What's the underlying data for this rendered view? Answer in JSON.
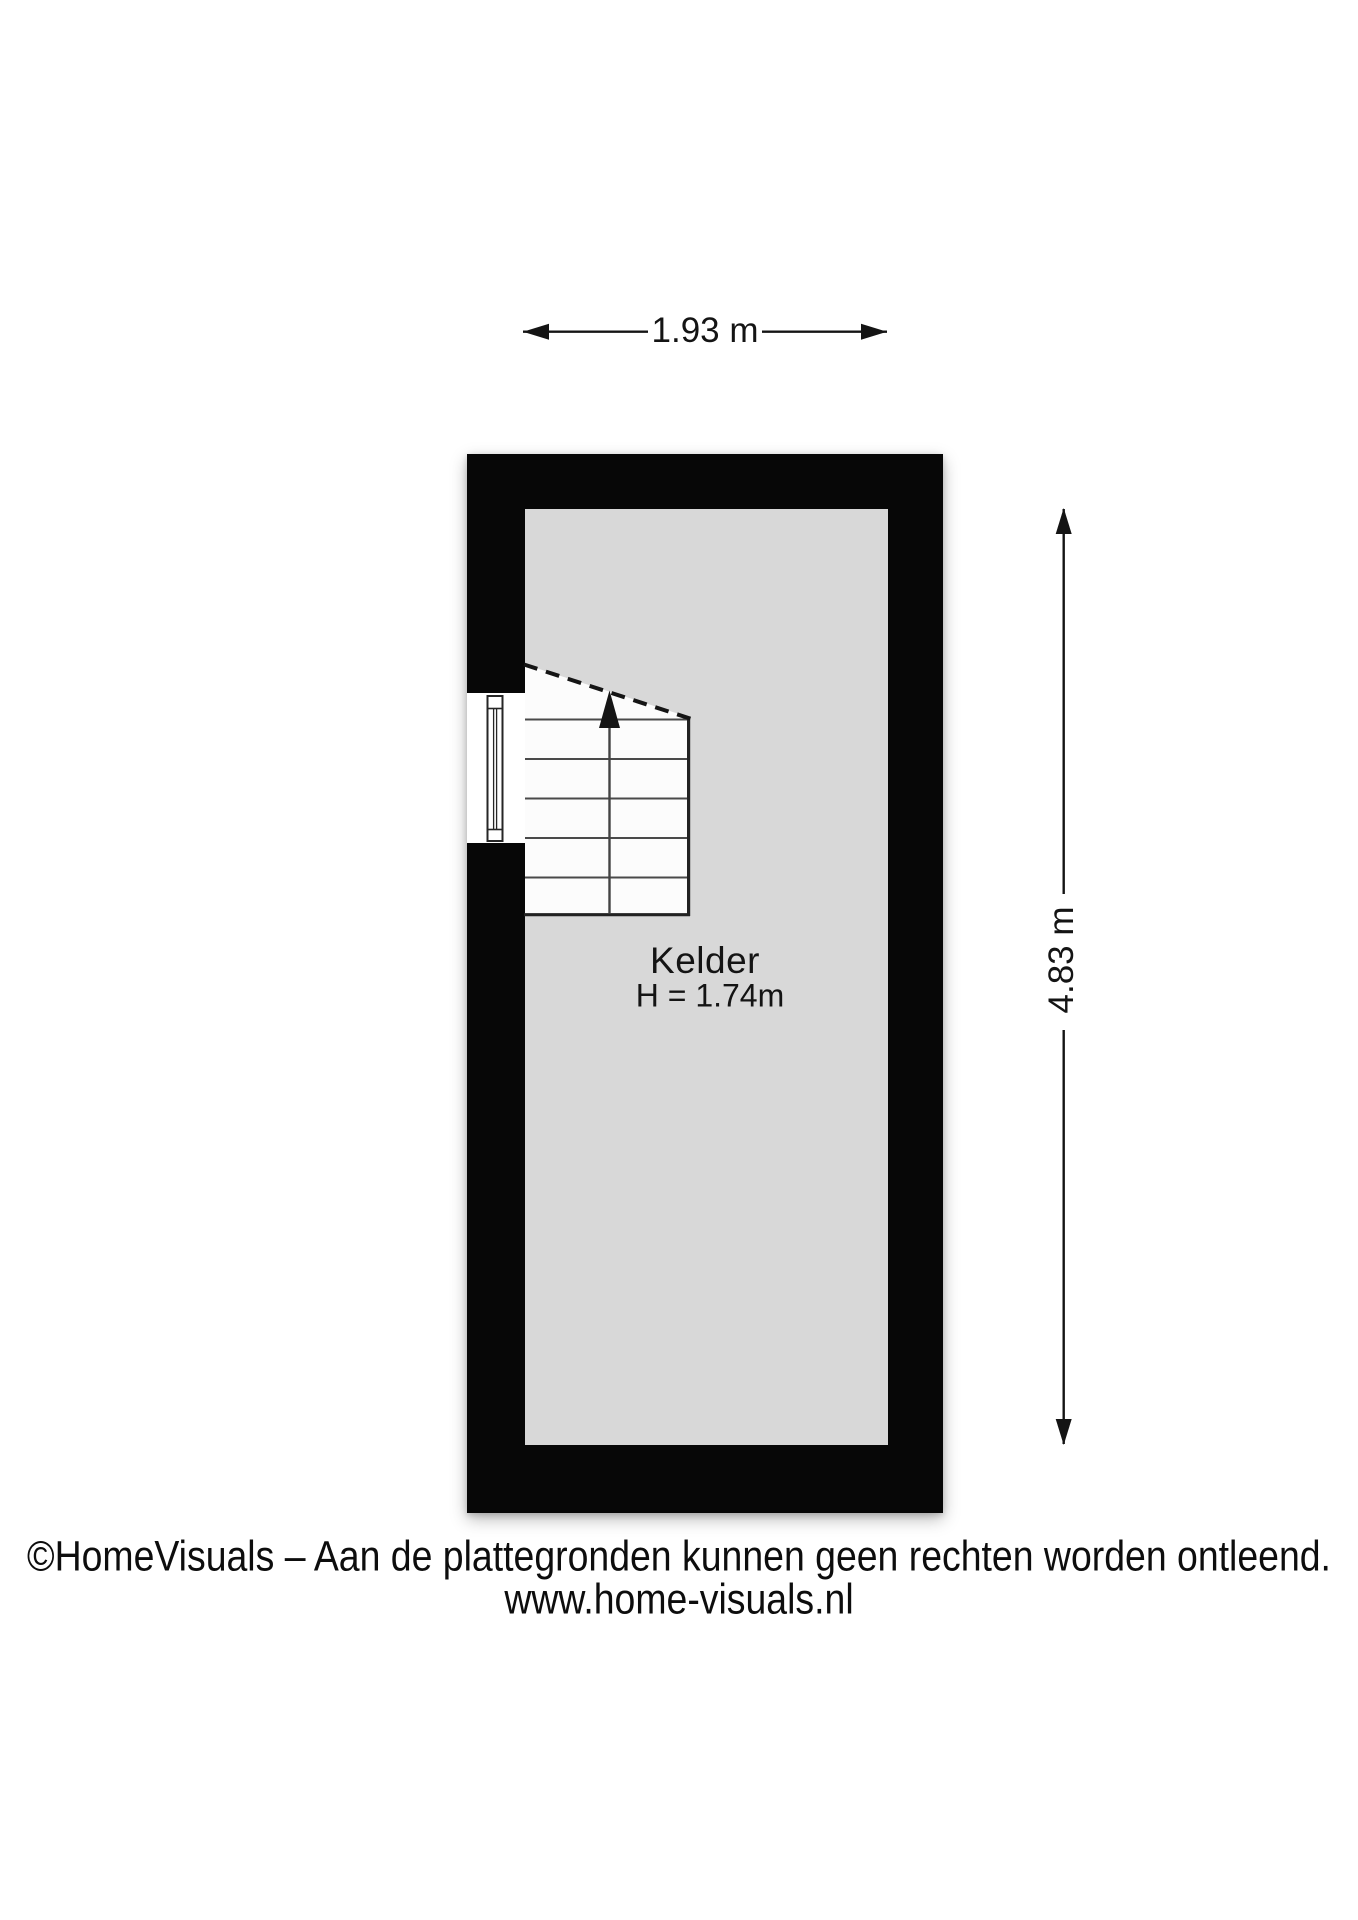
{
  "meta": {
    "type": "floorplan",
    "floor_name": "Kelder"
  },
  "plan": {
    "room": {
      "label": "Kelder",
      "ceiling_height": "H = 1.74m"
    },
    "dimensions": {
      "width": {
        "label": "1.93 m"
      },
      "height": {
        "label": "4.83 m"
      }
    },
    "features": {
      "stairs_icon": "stairs-up-arrow-icon",
      "window_icon": "window-symbol"
    },
    "colors": {
      "wall": "#070707",
      "floor": "#d8d8d8",
      "stairs": "#fcfcfc",
      "background": "#ffffff",
      "text": "#141414"
    }
  },
  "footer": {
    "copyright": "©HomeVisuals – Aan de plattegronden kunnen geen rechten worden ontleend.",
    "website": "www.home-visuals.nl"
  }
}
